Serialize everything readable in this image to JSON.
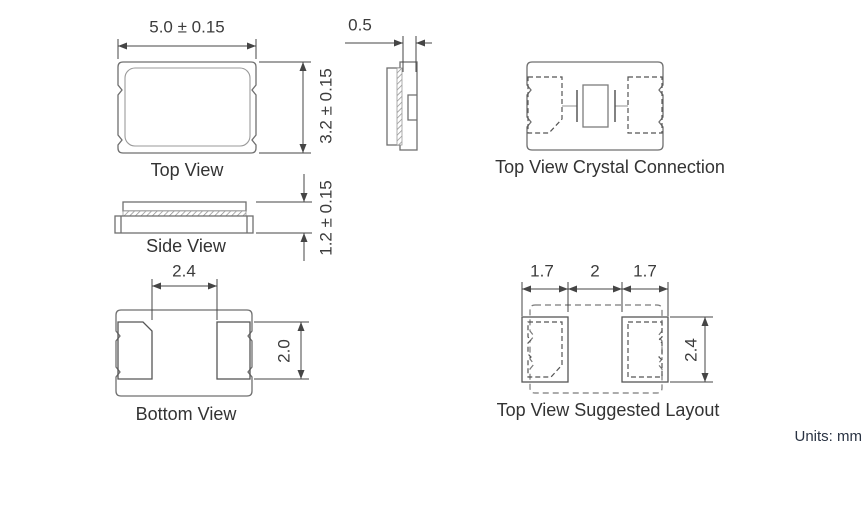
{
  "page": {
    "units_note": "Units: mm"
  },
  "colors": {
    "background": "#ffffff",
    "dimension_lines": "#454545",
    "outline_medium": "#6f6f6f",
    "outline_light": "#9a9a9a",
    "text": "#3c3c3c",
    "units_text": "#2a3343"
  },
  "views": {
    "top_view": {
      "label": "Top View",
      "width_dim": "5.0 ± 0.15",
      "height_dim": "3.2 ± 0.15"
    },
    "end_view": {
      "thickness_dim": "0.5"
    },
    "side_view": {
      "label": "Side View",
      "height_dim": "1.2 ± 0.15"
    },
    "crystal_connection": {
      "label": "Top View Crystal Connection"
    },
    "bottom_view": {
      "label": "Bottom View",
      "pad_span_dim": "2.4",
      "pad_height_dim": "2.0"
    },
    "suggested_layout": {
      "label": "Top View Suggested Layout",
      "left_pad_dim": "1.7",
      "gap_dim": "2",
      "right_pad_dim": "1.7",
      "pad_height_dim": "2.4"
    }
  }
}
